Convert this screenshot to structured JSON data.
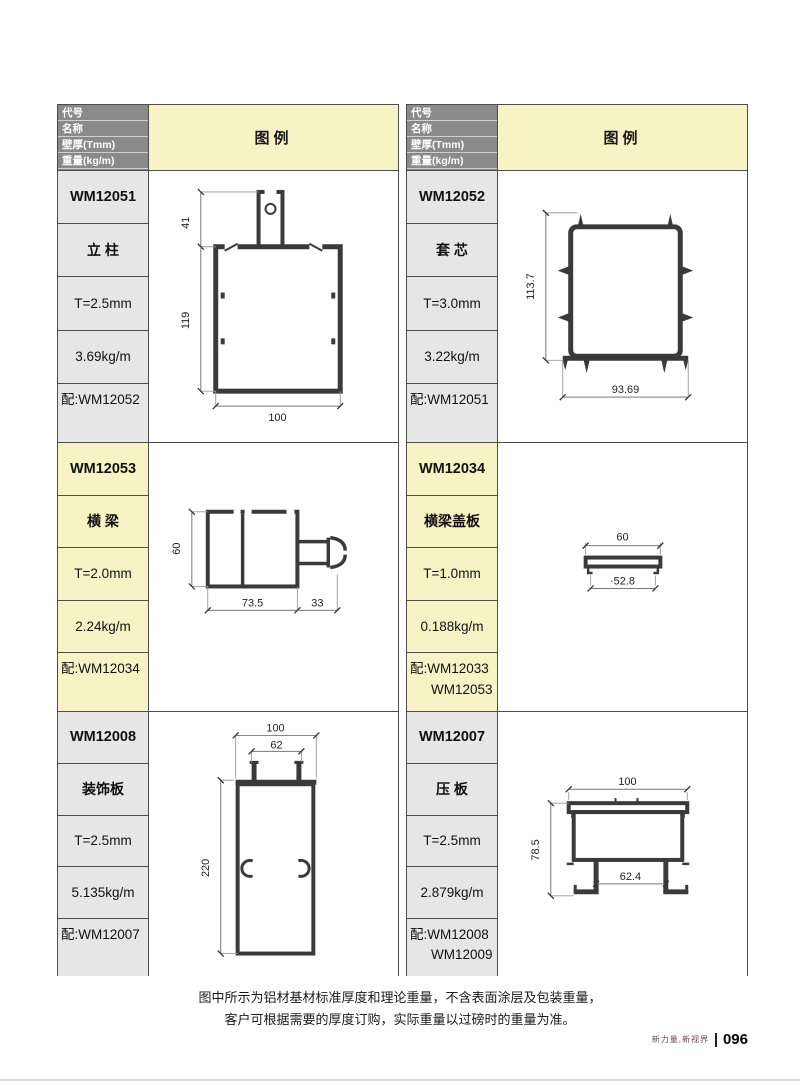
{
  "header": {
    "rows": [
      "代号",
      "名称",
      "壁厚(Tmm)",
      "重量(kg/m)",
      "配套"
    ],
    "legend_label": "图例"
  },
  "profiles": [
    {
      "code": "WM12051",
      "name": "立 柱",
      "thickness": "T=2.5mm",
      "weight": "3.69kg/m",
      "match": [
        "配:WM12052"
      ],
      "dims": [
        "41",
        "119",
        "100"
      ]
    },
    {
      "code": "WM12052",
      "name": "套 芯",
      "thickness": "T=3.0mm",
      "weight": "3.22kg/m",
      "match": [
        "配:WM12051"
      ],
      "dims": [
        "113.7",
        "93.69"
      ]
    },
    {
      "code": "WM12053",
      "name": "横 梁",
      "thickness": "T=2.0mm",
      "weight": "2.24kg/m",
      "match": [
        "配:WM12034"
      ],
      "dims": [
        "60",
        "73.5",
        "33"
      ]
    },
    {
      "code": "WM12034",
      "name": "横梁盖板",
      "thickness": "T=1.0mm",
      "weight": "0.188kg/m",
      "match": [
        "配:WM12033",
        "WM12053"
      ],
      "dims": [
        "60",
        "·52.8"
      ]
    },
    {
      "code": "WM12008",
      "name": "装饰板",
      "thickness": "T=2.5mm",
      "weight": "5.135kg/m",
      "match": [
        "配:WM12007"
      ],
      "dims": [
        "100",
        "62",
        "220"
      ]
    },
    {
      "code": "WM12007",
      "name": "压 板",
      "thickness": "T=2.5mm",
      "weight": "2.879kg/m",
      "match": [
        "配:WM12008",
        "WM12009"
      ],
      "dims": [
        "100",
        "78.5",
        "62.4"
      ]
    }
  ],
  "footer": {
    "lines": [
      "图中所示为铝材基材标准厚度和理论重量，不含表面涂层及包装重量，",
      "客户可根据需要的厚度订购，实际重量以过磅时的重量为准。"
    ],
    "tagline": "新力量,新视界",
    "page_number": "096"
  },
  "colors": {
    "header_bg": "#8a8a8a",
    "legend_bg": "#f7f3c5",
    "cell_bg": "#e6e6e6",
    "highlight_bg": "#f7f3c5",
    "border": "#4d4d4d",
    "drawing_stroke": "#3a3a3a"
  }
}
